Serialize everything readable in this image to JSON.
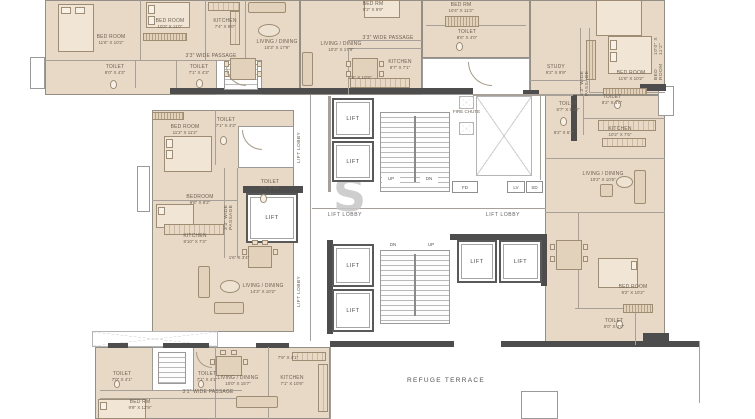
{
  "watermark": {
    "text": "S"
  },
  "terrace": {
    "label": "REFUGE TERRACE"
  },
  "core": {
    "lift": "LIFT",
    "lift_lobby": "LIFT LOBBY",
    "fire_chute": "FIRE CHUTE",
    "up": "UP",
    "dn": "DN",
    "fd": "FD",
    "lv": "LV",
    "sd": "SD"
  },
  "rooms": {
    "a_bed1": {
      "name": "BED ROOM",
      "dims": "11'6\" X 10'2\""
    },
    "a_bed2": {
      "name": "BED ROOM",
      "dims": "10'3\" X 11'0\""
    },
    "a_kitchen": {
      "name": "KITCHEN",
      "dims": "7'4\" X 9'0\""
    },
    "a_passage": {
      "name": "3'3\" WIDE PASSAGE"
    },
    "a_toilet1": {
      "name": "TOILET",
      "dims": "8'0\" X 4'3\""
    },
    "a_toilet2": {
      "name": "TOILET",
      "dims": "7'1\" X 4'3\""
    },
    "a_living": {
      "name": "LIVING / DINING",
      "dims": "10'3\" X 17'9\""
    },
    "b_living": {
      "name": "LIVING / DINING",
      "dims": "10'3\" X 17'9\""
    },
    "b_bed": {
      "name": "BED RM",
      "dims": "9'2\" X 9'9\""
    },
    "b_passage": {
      "name": "3'3\" WIDE PASSAGE"
    },
    "b_kitchen": {
      "name": "KITCHEN",
      "dims": "9'7\" X 7'1\""
    },
    "b_deck": {
      "dims": "2'6\" X 10'8\""
    },
    "c_bed": {
      "name": "BED RM",
      "dims": "10'4\" X 11'2\""
    },
    "c_toilet": {
      "name": "TOILET",
      "dims": "8'6\" X 4'0\""
    },
    "d_study": {
      "name": "STUDY",
      "dims": "9'2\" X 9'9\""
    },
    "d_passage": {
      "name": "3'3\" WIDE PASSAGE"
    },
    "d_bed_top": {
      "name": "BED ROOM",
      "dims": "10'0\" X 11'2\""
    },
    "d_bed": {
      "name": "BED ROOM",
      "dims": "11'6\" X 10'2\""
    },
    "d_toilet1": {
      "name": "TOILET",
      "dims": "5'7\" X 5'10\""
    },
    "d_toilet2": {
      "name": "TOILET",
      "dims": "8'2\" X 4'0\""
    },
    "d_foyer": {
      "dims": "8'2\" X 6'1\""
    },
    "d_kitchen": {
      "name": "KITCHEN",
      "dims": "10'2\" X 7'5\""
    },
    "d_living": {
      "name": "LIVING / DINING",
      "dims": "10'2\" X 10'6\""
    },
    "e_bed": {
      "name": "BED ROOM",
      "dims": "9'2\" X 10'2\""
    },
    "e_toilet": {
      "name": "TOILET",
      "dims": "8'0\" X 4'0\""
    },
    "f_bed1": {
      "name": "BED ROOM",
      "dims": "11'2\" X 11'2\""
    },
    "f_toilet1": {
      "name": "TOILET",
      "dims": "7'1\" X 4'3\""
    },
    "f_toilet2": {
      "name": "TOILET",
      "dims": "7'2\" X 4'6\""
    },
    "f_bed2": {
      "name": "BEDROOM",
      "dims": "9'8\" X 8'2\""
    },
    "f_passage": {
      "name": "3'3\" WIDE PASSAGE"
    },
    "f_kitchen": {
      "name": "KITCHEN",
      "dims": "8'10\" X 7'3\""
    },
    "f_living": {
      "name": "LIVING / DINING",
      "dims": "14'3\" X 10'2\""
    },
    "f_niche": {
      "dims": "1'6\" X 3'4\""
    },
    "g_toilet1": {
      "name": "TOILET",
      "dims": "7'0\" X 4'1\""
    },
    "g_toilet2": {
      "name": "TOILET",
      "dims": "7'1\" X 4'1\""
    },
    "g_passage": {
      "name": "3'1\" WIDE PASSAGE"
    },
    "g_bed": {
      "name": "BED RM",
      "dims": "9'9\" X 12'9\""
    },
    "g_living": {
      "name": "LIVING / DINING",
      "dims": "10'0\" X 15'7\""
    },
    "g_kitchen": {
      "name": "KITCHEN",
      "dims": "7'1\" X 10'8\""
    },
    "g_deck": {
      "dims": "7'9\" X 4'1\""
    }
  }
}
